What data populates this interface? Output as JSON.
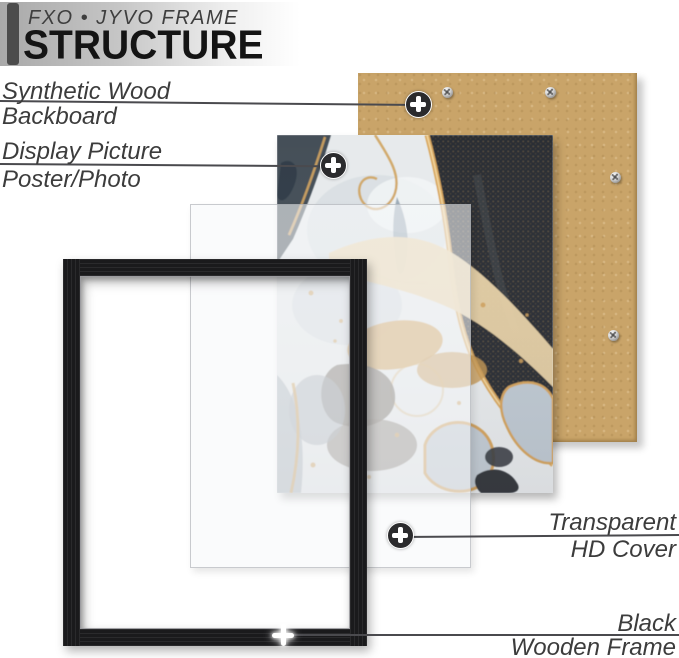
{
  "header": {
    "brand": "FXO • JYVO FRAME",
    "title": "STRUCTURE"
  },
  "callouts": [
    {
      "id": "backboard",
      "line1": "Synthetic Wood",
      "line2": "Backboard"
    },
    {
      "id": "display-picture",
      "line1": "Display Picture",
      "line2": "Poster/Photo"
    },
    {
      "id": "hd-cover",
      "line1": "Transparent",
      "line2": "HD Cover"
    },
    {
      "id": "wooden-frame",
      "line1": "Black",
      "line2": "Wooden Frame"
    }
  ],
  "colors": {
    "backboard_tan": "#c9a469",
    "frame_black": "#1a1a1c",
    "gold_accent": "#d9a75f",
    "label_text": "#3c3c3c",
    "leader_line": "#4a4a4e",
    "title_bar": "#4c4c4c"
  }
}
